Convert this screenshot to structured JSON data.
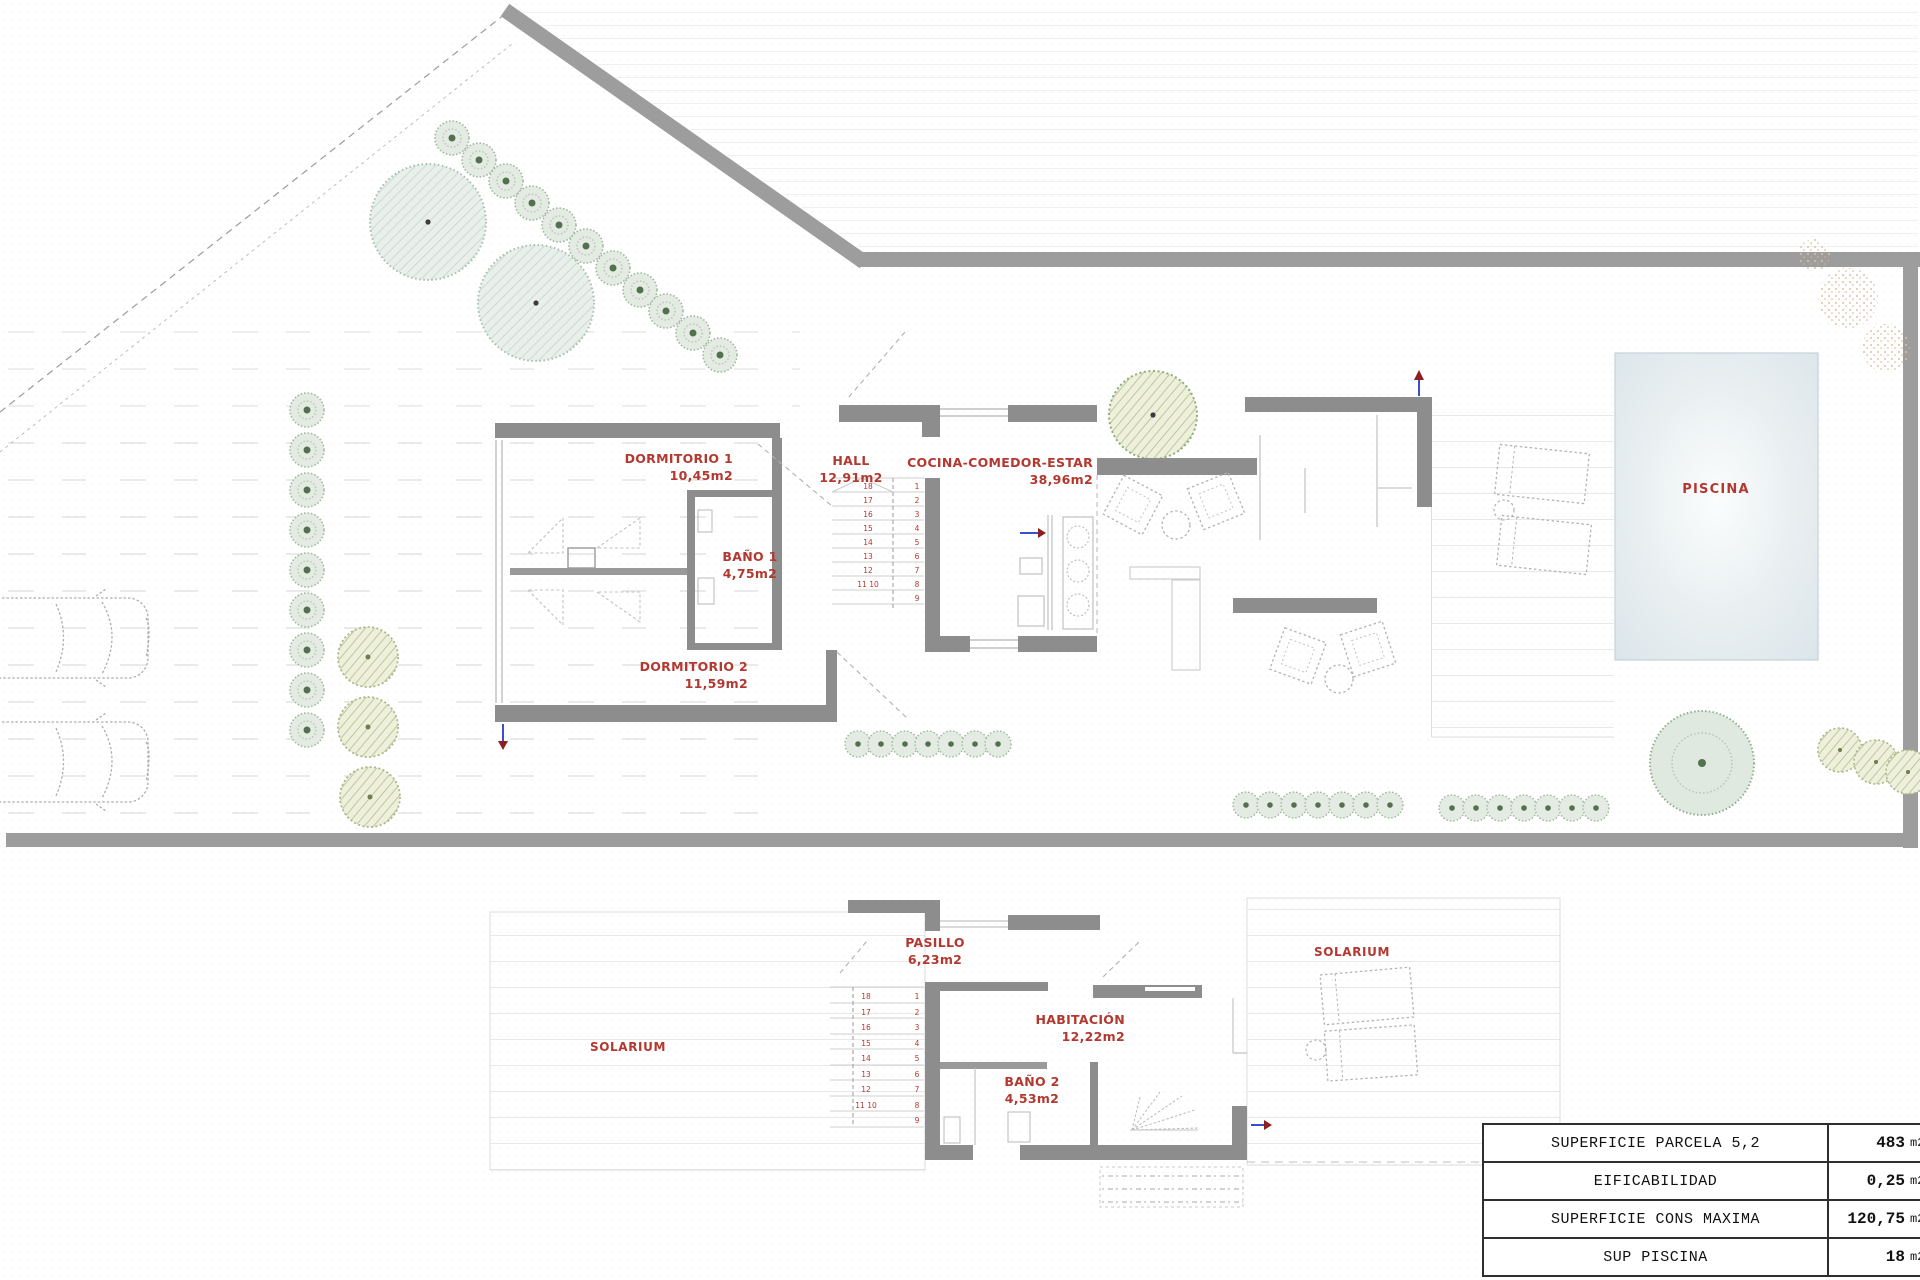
{
  "plan": {
    "ground_floor": {
      "dormitorio1": {
        "name": "DORMITORIO 1",
        "area": "10,45m2"
      },
      "hall": {
        "name": "HALL",
        "area": "12,91m2"
      },
      "cocina_comedor_estar": {
        "name": "COCINA-COMEDOR-ESTAR",
        "area": "38,96m2"
      },
      "bano1": {
        "name": "BAÑO 1",
        "area": "4,75m2"
      },
      "dormitorio2": {
        "name": "DORMITORIO 2",
        "area": "11,59m2"
      },
      "piscina": {
        "name": "PISCINA"
      }
    },
    "first_floor": {
      "pasillo": {
        "name": "PASILLO",
        "area": "6,23m2"
      },
      "solarium_left": {
        "name": "SOLARIUM"
      },
      "habitacion": {
        "name": "HABITACIÓN",
        "area": "12,22m2"
      },
      "bano2": {
        "name": "BAÑO 2",
        "area": "4,53m2"
      },
      "solarium_right": {
        "name": "SOLARIUM"
      }
    },
    "stairs": {
      "left_numbers": [
        "18",
        "17",
        "16",
        "15",
        "14",
        "13",
        "12",
        "11 10"
      ],
      "right_numbers": [
        "1",
        "2",
        "3",
        "4",
        "5",
        "6",
        "7",
        "8",
        "9"
      ]
    }
  },
  "summary_table": {
    "rows": [
      {
        "label": "SUPERFICIE PARCELA 5,2",
        "value": "483",
        "unit": "m2"
      },
      {
        "label": "EIFICABILIDAD",
        "value": "0,25",
        "unit": "m2"
      },
      {
        "label": "SUPERFICIE CONS MAXIMA",
        "value": "120,75",
        "unit": "m2"
      },
      {
        "label": "SUP PISCINA",
        "value": "18",
        "unit": "m2"
      }
    ]
  },
  "colors": {
    "wall_gray": "#8d8d8d",
    "boundary_gray": "#9d9d9d",
    "label_red": "#b23830",
    "pool_blue": "#dfe9ec",
    "vegetation_green": "#53714f",
    "arrow_blue": "#3a4fd0",
    "arrow_red": "#8c1f1f"
  }
}
